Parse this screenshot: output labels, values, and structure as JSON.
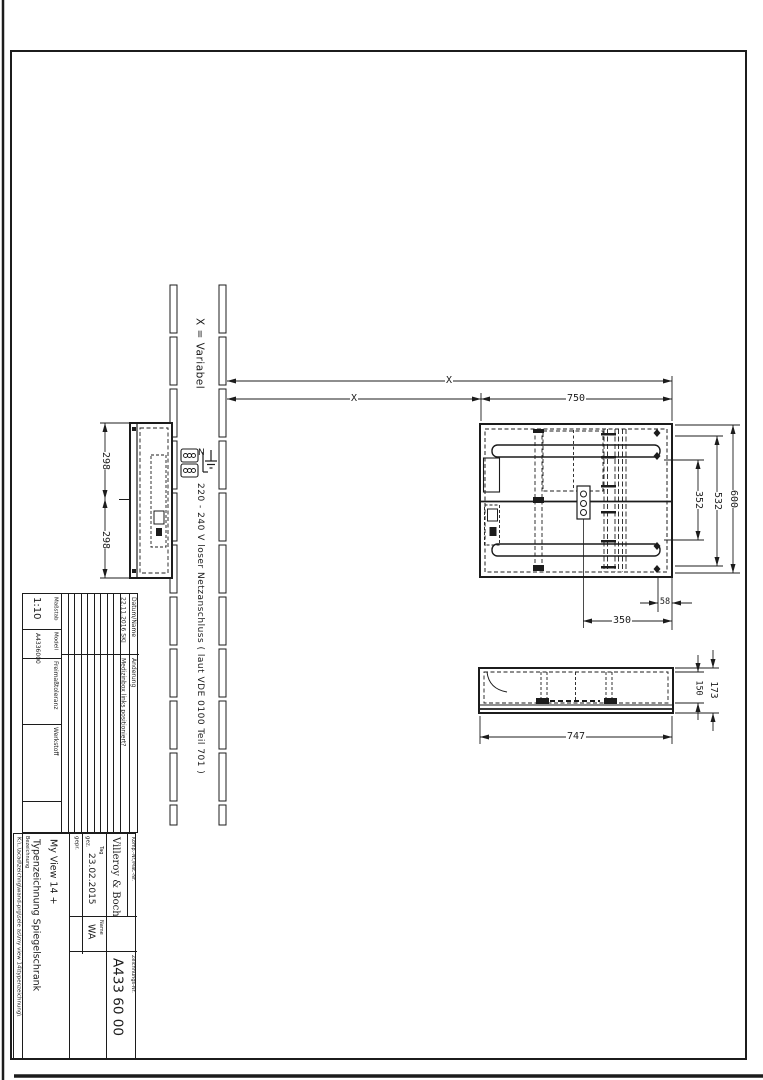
{
  "annotations": {
    "variable_note": "X = Variabel",
    "power_note": "220 - 240 V loser Netzanschluss ( laut VDE 0100 Teil 701 )",
    "neutral_label": "N"
  },
  "dimensions": {
    "x_top": "X",
    "x_bottom": "X",
    "width_750": "750",
    "height_600": "600",
    "height_532": "532",
    "height_352": "352",
    "offset_58": "58",
    "offset_350": "350",
    "side_298_top": "298",
    "side_298_bottom": "298",
    "depth_747": "747",
    "depth_173": "173",
    "depth_150": "150"
  },
  "title_block": {
    "masstab_label": "Maßstab",
    "masstab_value": "1:10",
    "modell_label": "Modell",
    "modell_value": "A4336000",
    "freimass_label": "Freimaßtoleranz",
    "werkstoff_label": "Werkstoff",
    "datum_name_label": "Datum/Name",
    "aenderung_label": "Änderung",
    "revision_date": "22.11.2016 SKJ",
    "revision_text": "Medizinbox links positioniert?",
    "bezeichnung_label": "Bezeichnung",
    "bezeichnung_line1": "Typenzeichnung Spiegelschrank",
    "bezeichnung_line2": "My View 14 +",
    "gez_label": "gez.",
    "gepr_label": "gepr.",
    "tag_label": "Tag",
    "tag_value": "23.02.2015",
    "name_label": "Name",
    "name_value": "WA",
    "company": "Villeroy & Boch",
    "komp_label": "Komp.-Nr./Mat.-Nr.",
    "zeichnung_label": "Zeichnungs-Nr.",
    "zeichnung_value": "A433 60 00",
    "file_path": "K:\\..\\acad\\zeichng\\wand-prg\\sele as\\my view 14\\typenzeichnung\\"
  },
  "colors": {
    "ink": "#1c1c1c",
    "paper": "#ffffff"
  }
}
